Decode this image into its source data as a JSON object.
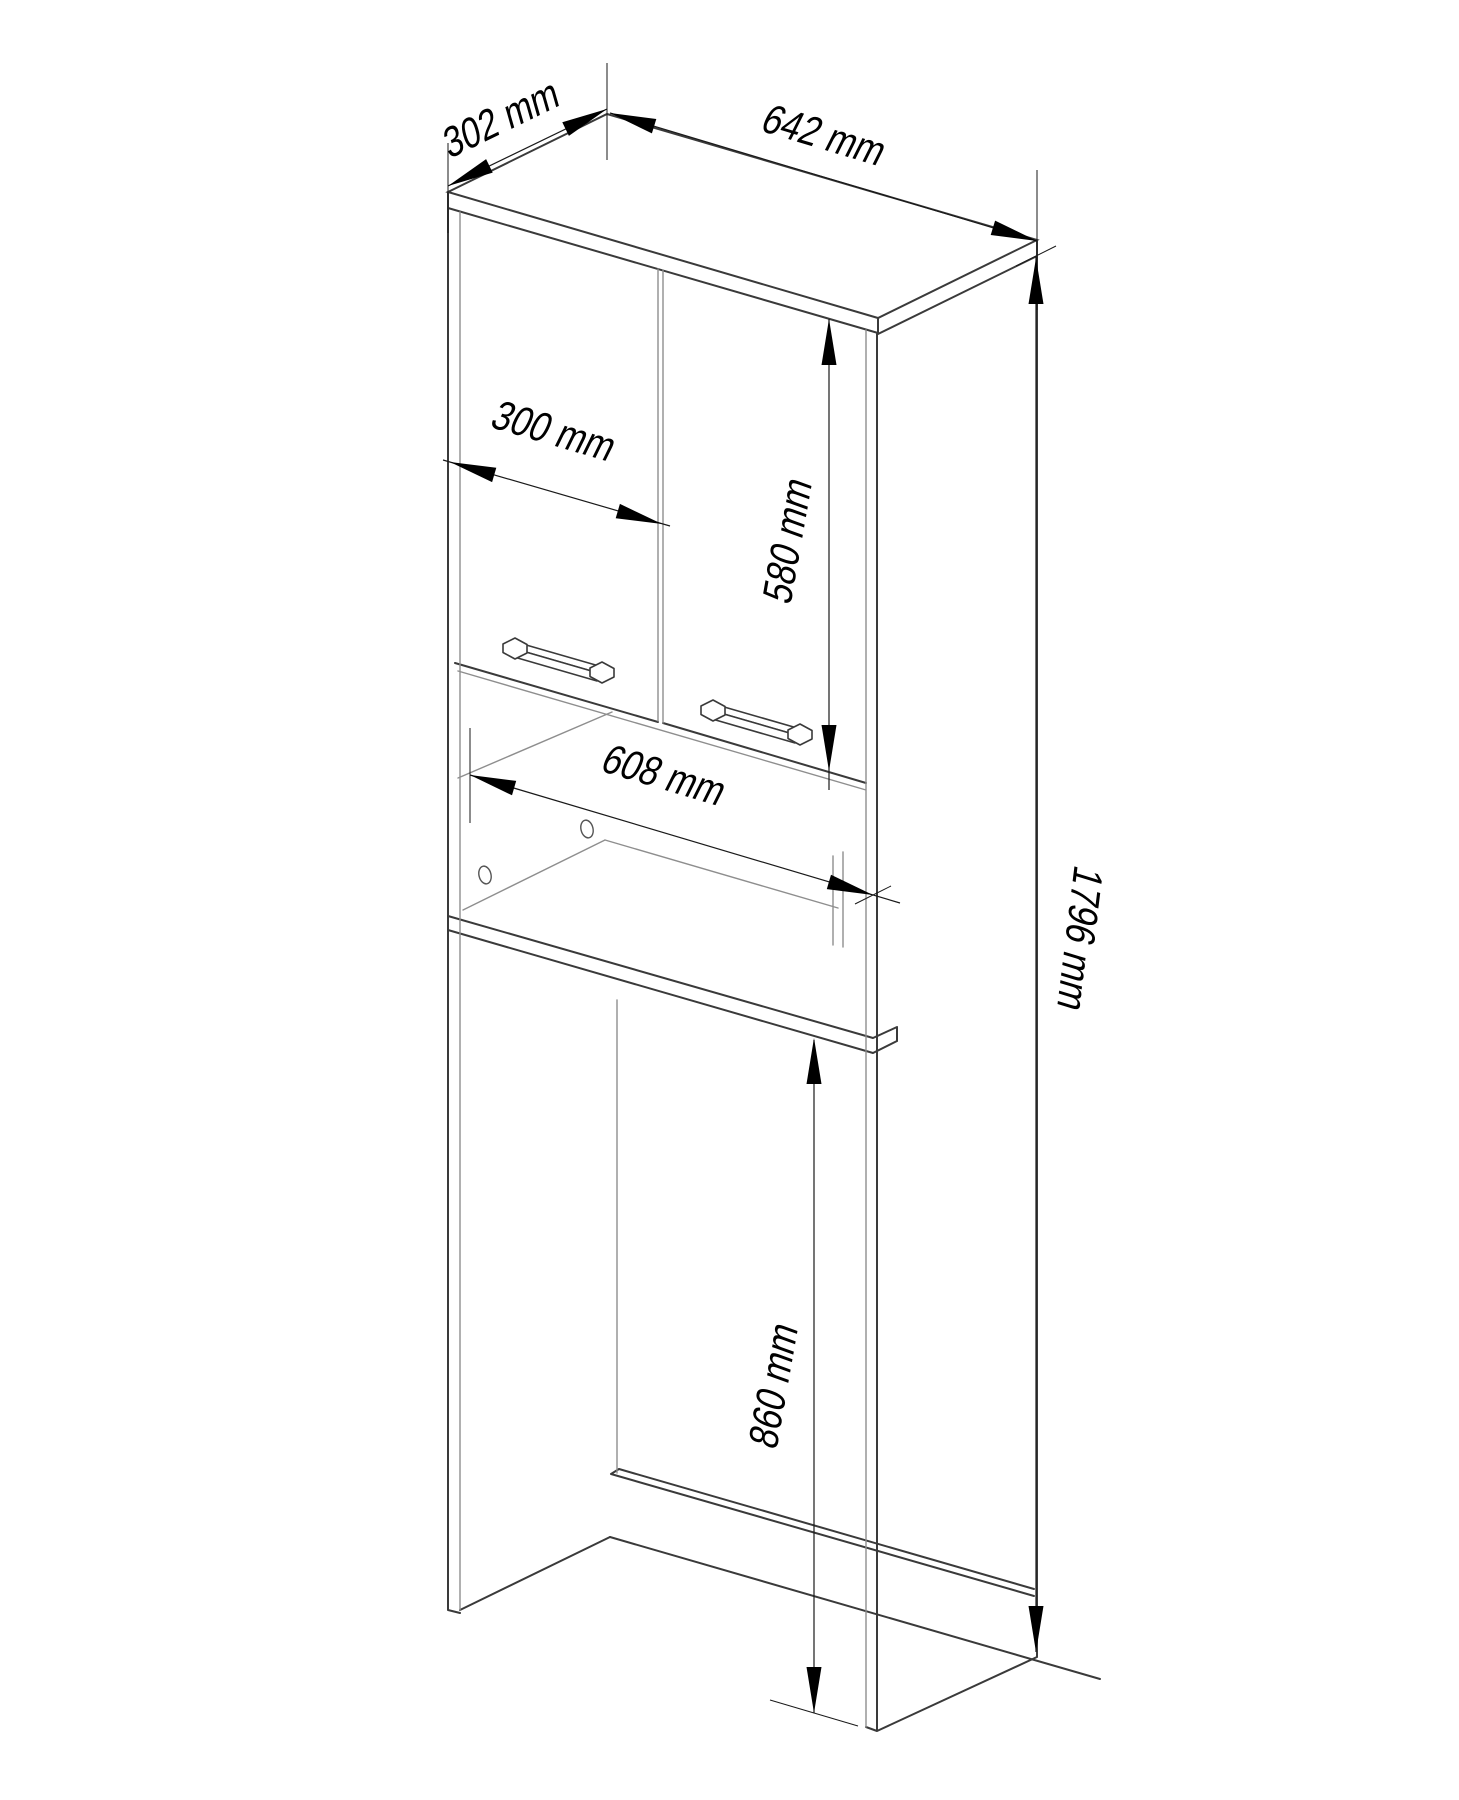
{
  "drawing": {
    "kind": "isometric furniture technical drawing",
    "subject": "tall bathroom cabinet over washing machine, two doors, open niche, plinth"
  },
  "dimensions": {
    "top_depth": "302 mm",
    "top_width": "642 mm",
    "door_width": "300 mm",
    "door_height": "580 mm",
    "niche_inner_width": "608 mm",
    "overall_height": "1796 mm",
    "washer_opening_height": "860 mm"
  },
  "colors": {
    "background": "#ffffff",
    "cabinet_edge": "#3a3a3a",
    "secondary_edge": "#8e8e8e",
    "dimension_line": "#1a1a1a",
    "arrow": "#000000",
    "label_text": "#000000"
  }
}
